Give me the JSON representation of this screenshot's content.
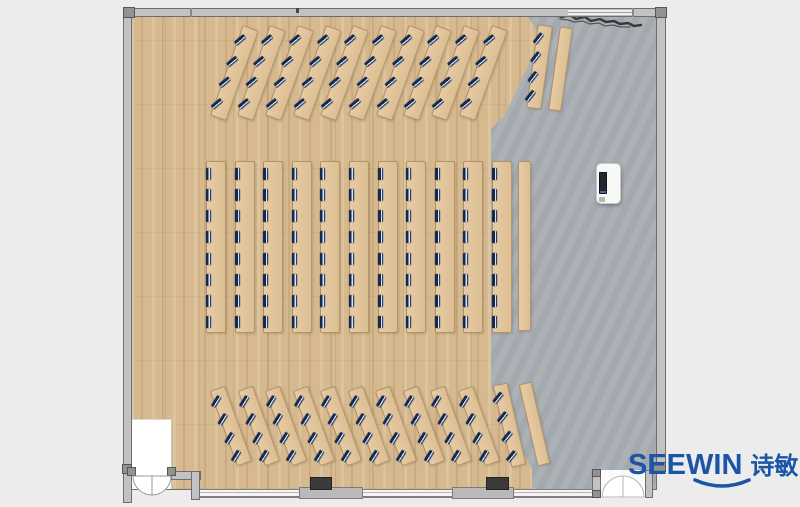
{
  "logo": {
    "brand": "SEEWIN",
    "brand_cn": "诗敏"
  },
  "colors": {
    "background": "#ECECEC",
    "concrete_floor": "#A8AEB3",
    "wood_floor": "#D6B98F",
    "desk_surface": "#E2C59C",
    "wall_gray": "#C2C2C2",
    "wall_outline": "#6E6E6E",
    "workstation_navy": "#16294D",
    "door_leaf": "#FFFFFF",
    "column_dark": "#3B3B3B",
    "logo_blue": "#1A55A7"
  },
  "floorplan": {
    "room": {
      "x": 123,
      "y": 7,
      "w": 545,
      "h": 497
    },
    "podium": {
      "x": 596,
      "y": 163,
      "w": 25,
      "h": 41
    },
    "workstations_total": 176,
    "desk_sections": [
      {
        "name": "front-angled-rows",
        "strips": 10,
        "seats_per_strip": 4,
        "center_x0": 234,
        "center_y0": 73,
        "spacing_x": 27.7,
        "strip_w": 17,
        "strip_h": 96,
        "rotation": 20,
        "seat_rotation": 30,
        "seat_pad": 8
      },
      {
        "name": "front-side-strip",
        "strips": 1,
        "seats_per_strip": 4,
        "center_x0": 539,
        "center_y0": 67,
        "spacing_x": 0,
        "strip_w": 15,
        "strip_h": 84,
        "rotation": 8,
        "seat_rotation": 30,
        "seat_pad": 7
      },
      {
        "name": "front-side-table",
        "strips": 1,
        "seats_per_strip": 0,
        "center_x0": 560,
        "center_y0": 69,
        "spacing_x": 0,
        "strip_w": 13,
        "strip_h": 84,
        "rotation": 8
      },
      {
        "name": "middle-rows",
        "strips": 11,
        "seats_per_strip": 8,
        "center_x0": 216,
        "center_y0": 247,
        "spacing_x": 28.6,
        "strip_w": 20,
        "strip_h": 172,
        "rotation": 0,
        "seat_rotation": 0,
        "seat_pad": 6
      },
      {
        "name": "middle-side-table",
        "strips": 1,
        "seats_per_strip": 0,
        "center_x0": 524,
        "center_y0": 246,
        "spacing_x": 0,
        "strip_w": 13,
        "strip_h": 170,
        "rotation": 0
      },
      {
        "name": "back-angled-rows",
        "strips": 10,
        "seats_per_strip": 4,
        "center_x0": 231,
        "center_y0": 426,
        "spacing_x": 27.5,
        "strip_w": 16,
        "strip_h": 80,
        "rotation": -20,
        "seat_rotation": 52,
        "seat_pad": 5
      },
      {
        "name": "back-side-strip",
        "strips": 1,
        "seats_per_strip": 4,
        "center_x0": 509,
        "center_y0": 425,
        "spacing_x": 0,
        "strip_w": 15,
        "strip_h": 84,
        "rotation": -13,
        "seat_rotation": 52,
        "seat_pad": 6
      },
      {
        "name": "back-side-table",
        "strips": 1,
        "seats_per_strip": 0,
        "center_x0": 534,
        "center_y0": 424,
        "spacing_x": 0,
        "strip_w": 13,
        "strip_h": 84,
        "rotation": -13
      }
    ]
  }
}
